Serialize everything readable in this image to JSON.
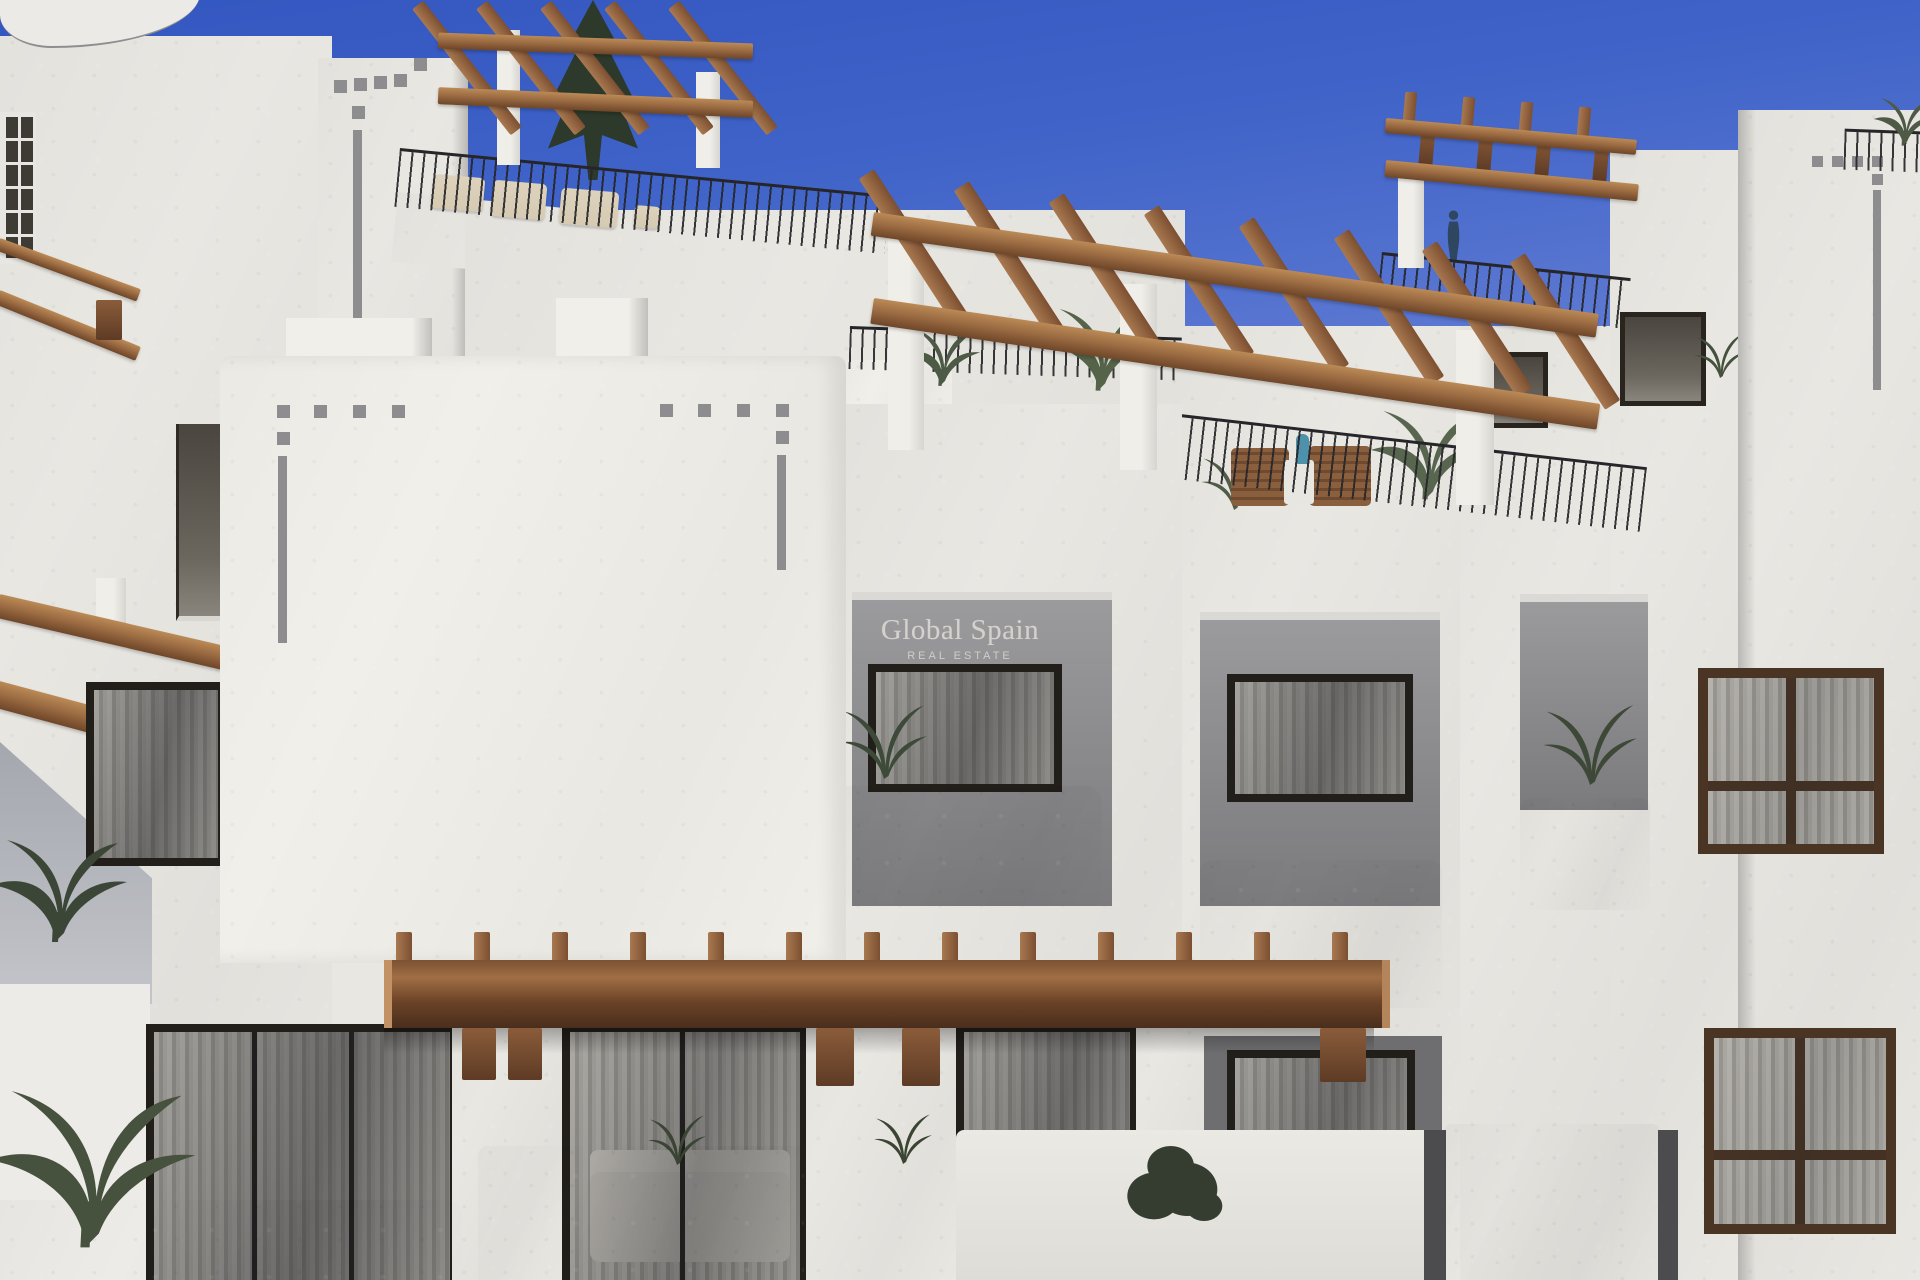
{
  "watermark": {
    "brand": "Global Spain",
    "tagline": "REAL ESTATE"
  },
  "colors": {
    "sky-top": "#3356c0",
    "sky-mid": "#5d79d2",
    "sky-low": "#93a8e4",
    "wall": "#e9e7e2",
    "wall-bright": "#f1efe9",
    "recess-top": "#9b9b9e",
    "recess-bottom": "#7b7b7e",
    "cutout": "#8d8d90",
    "wood-light": "#bb8a56",
    "wood-mid": "#9a6a42",
    "wood-dark": "#5e3b25",
    "window-frame": "#221e19",
    "window-frame-wood": "#4a3423",
    "curtain-light": "#c3c0b9",
    "curtain-dark": "#a3a099",
    "railing": "#26262a",
    "furniture-beige": "#d6cab2",
    "chair-wood": "#8a5f3e",
    "bottle-teal": "#4d92aa",
    "statue-blue": "#2e4660",
    "watermark-text": "#dbd7d1"
  }
}
